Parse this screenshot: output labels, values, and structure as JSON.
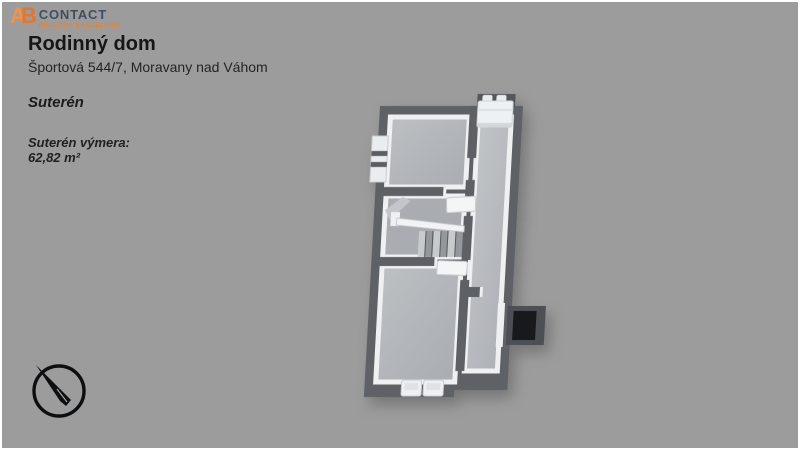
{
  "canvas": {
    "width": 800,
    "height": 450,
    "background": "#9c9c9c"
  },
  "logo": {
    "monogram_a": "A",
    "monogram_b": "B",
    "name": "CONTACT",
    "tagline": "REALITNÁ KANCELÁRIA",
    "orange": "#e5832f",
    "navy": "#3d4f61"
  },
  "header": {
    "title": "Rodinný dom",
    "subtitle": "Športová 544/7, Moravany nad Váhom"
  },
  "floor": {
    "label": "Suterén",
    "area_label": "Suterén výmera:",
    "area_value": "62,82 m²"
  },
  "plan": {
    "wall_color": "#5e6266",
    "inner_wall_color": "#eef0f2",
    "floor_color": "#b2b5b9",
    "hallway_floor_color": "#babdc1",
    "window_well_frame_color": "#4c5055",
    "window_well_color": "#17191c",
    "compass_color": "#0d0e10"
  }
}
